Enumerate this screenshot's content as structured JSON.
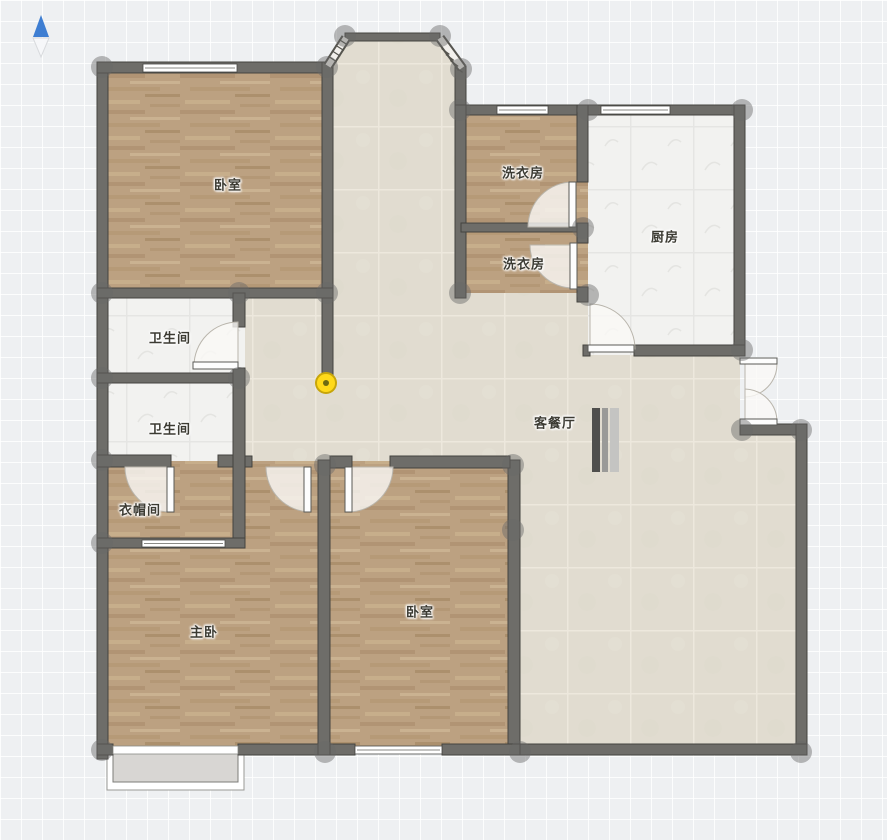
{
  "app": {
    "name": "floor-plan-editor-canvas"
  },
  "colors": {
    "canvas_bg": "#eef0f2",
    "grid_line": "#ffffff",
    "wall_fill": "#6e6d69",
    "wall_stroke": "#44433f",
    "wood_floor": "#bca181",
    "beige_tile": "#e1dcd0",
    "white_tile": "#f2f2f0",
    "handle": "rgba(105,105,105,0.45)",
    "door_leaf": "#fdfdfd",
    "door_swing_fill": "rgba(250,249,246,0.8)",
    "door_swing_stroke": "#b9b5ac",
    "window_fill": "#ffffff",
    "window_stroke": "#4a4a46",
    "selected_point": "#ffd91a",
    "compass_north": "#3e7ed2"
  },
  "compass": {
    "x": 41,
    "y": 15,
    "north_color": "#3e7ed2",
    "south_color": "#f6f7f9",
    "south_edge": "#d8dadd"
  },
  "marker": {
    "x": 326,
    "y": 383,
    "r": 10,
    "fill": "#ffd91a",
    "ring": "#c7a50a",
    "dot": "#6e6a12"
  },
  "rooms": [
    {
      "id": "bedroom-top",
      "label": "卧室",
      "x": 228,
      "y": 184
    },
    {
      "id": "laundry-upper",
      "label": "洗衣房",
      "x": 523,
      "y": 172
    },
    {
      "id": "laundry-lower",
      "label": "洗衣房",
      "x": 524,
      "y": 263
    },
    {
      "id": "kitchen",
      "label": "厨房",
      "x": 665,
      "y": 236
    },
    {
      "id": "bath-upper",
      "label": "卫生间",
      "x": 170,
      "y": 337
    },
    {
      "id": "bath-lower",
      "label": "卫生间",
      "x": 170,
      "y": 428
    },
    {
      "id": "living-dining",
      "label": "客餐厅",
      "x": 555,
      "y": 422
    },
    {
      "id": "cloakroom",
      "label": "衣帽间",
      "x": 140,
      "y": 509
    },
    {
      "id": "master-bedroom",
      "label": "主卧",
      "x": 204,
      "y": 631
    },
    {
      "id": "bedroom-bottom",
      "label": "卧室",
      "x": 420,
      "y": 611
    }
  ],
  "plan": {
    "beige_polys": [
      "345,36 440,36 464,66 464,110 327,110 327,62",
      "327,62 461,62 461,298 327,298",
      "240,293 588,293 588,350 740,350 740,430 801,430 801,748 514,748 514,464 240,464"
    ],
    "white_rects": [
      [
        588,
        110,
        152,
        245
      ],
      [
        103,
        293,
        142,
        85
      ],
      [
        103,
        378,
        142,
        83
      ]
    ],
    "wood_rects": [
      [
        103,
        67,
        224,
        226
      ],
      [
        461,
        110,
        127,
        118
      ],
      [
        461,
        228,
        127,
        65
      ],
      [
        103,
        461,
        224,
        292
      ],
      [
        326,
        461,
        188,
        292
      ]
    ],
    "walls": [
      [
        97,
        62,
        11,
        697
      ],
      [
        97,
        62,
        236,
        11
      ],
      [
        322,
        62,
        11,
        321
      ],
      [
        97,
        288,
        236,
        10
      ],
      [
        345,
        33,
        95,
        8
      ],
      [
        455,
        66,
        11,
        49
      ],
      [
        455,
        105,
        290,
        10
      ],
      [
        455,
        105,
        11,
        193
      ],
      [
        461,
        223,
        121,
        9
      ],
      [
        577,
        105,
        11,
        77
      ],
      [
        577,
        223,
        11,
        20
      ],
      [
        577,
        287,
        11,
        15
      ],
      [
        734,
        105,
        11,
        250
      ],
      [
        583,
        345,
        7,
        11
      ],
      [
        634,
        345,
        111,
        11
      ],
      [
        740,
        424,
        67,
        11
      ],
      [
        796,
        424,
        11,
        331
      ],
      [
        510,
        744,
        297,
        11
      ],
      [
        508,
        460,
        12,
        295
      ],
      [
        97,
        744,
        16,
        11
      ],
      [
        238,
        744,
        117,
        11
      ],
      [
        442,
        744,
        78,
        11
      ],
      [
        97,
        455,
        74,
        12
      ],
      [
        218,
        455,
        27,
        12
      ],
      [
        240,
        456,
        12,
        11
      ],
      [
        318,
        460,
        12,
        295
      ],
      [
        330,
        456,
        22,
        12
      ],
      [
        390,
        456,
        120,
        12
      ],
      [
        97,
        373,
        148,
        10
      ],
      [
        233,
        293,
        12,
        34
      ],
      [
        233,
        368,
        12,
        177
      ],
      [
        97,
        538,
        148,
        10
      ]
    ],
    "windows": [
      [
        143,
        64,
        94,
        8
      ],
      [
        497,
        106,
        51,
        8
      ],
      [
        601,
        106,
        69,
        8
      ],
      [
        142,
        540,
        83,
        7
      ],
      [
        355,
        746,
        87,
        8
      ]
    ],
    "bay": {
      "bands": [
        [
          328,
          66,
          346,
          38
        ],
        [
          440,
          38,
          462,
          68
        ]
      ],
      "ticks": [
        [
          328.3,
          56.3,
          336.7,
          61.7
        ],
        [
          331.9,
          50.7,
          340.3,
          56.1
        ],
        [
          335.5,
          45.1,
          343.9,
          50.5
        ],
        [
          339.1,
          39.5,
          347.5,
          44.9
        ],
        [
          441.5,
          48.5,
          449.4,
          54.4
        ],
        [
          445.9,
          54.5,
          453.8,
          60.4
        ],
        [
          450.3,
          60.5,
          458.2,
          66.4
        ],
        [
          454.7,
          66.5,
          462.6,
          72.4
        ]
      ]
    },
    "door_leaves": [
      [
        569,
        182,
        7,
        45
      ],
      [
        570,
        243,
        7,
        46
      ],
      [
        588,
        345,
        46,
        7
      ],
      [
        193,
        362,
        45,
        7
      ],
      [
        167,
        467,
        7,
        45
      ],
      [
        304,
        467,
        7,
        45
      ],
      [
        345,
        467,
        7,
        45
      ],
      [
        740,
        358,
        37,
        6
      ],
      [
        740,
        419,
        37,
        6
      ]
    ],
    "door_swings": [
      "M573,227 L573,182 A45,45 0 0 0 528,227 Z",
      "M573,245 L573,288 A43,43 0 0 1 530,245 Z",
      "M590,349 L635,349 A45,45 0 0 0 590,304 Z",
      "M238,366 L194,366 A44,44 0 0 1 238,322 Z",
      "M170,467 L170,512 A45,45 0 0 1 125,467 Z",
      "M311,467 L311,512 A45,45 0 0 1 266,467 Z",
      "M348,467 L348,512 A45,45 0 0 0 393,467 Z",
      "M745,364 L777,364 A33,33 0 0 1 745,397 Z",
      "M745,422 L777,422 A33,33 0 0 0 745,389 Z"
    ],
    "handles": [
      [
        102,
        67
      ],
      [
        327,
        67
      ],
      [
        345,
        36
      ],
      [
        440,
        36
      ],
      [
        461,
        69
      ],
      [
        102,
        293
      ],
      [
        239,
        293
      ],
      [
        327,
        293
      ],
      [
        460,
        110
      ],
      [
        588,
        110
      ],
      [
        742,
        110
      ],
      [
        583,
        228
      ],
      [
        460,
        293
      ],
      [
        588,
        295
      ],
      [
        742,
        350
      ],
      [
        742,
        430
      ],
      [
        801,
        430
      ],
      [
        102,
        378
      ],
      [
        239,
        378
      ],
      [
        102,
        460
      ],
      [
        325,
        465
      ],
      [
        513,
        465
      ],
      [
        102,
        543
      ],
      [
        513,
        530
      ],
      [
        102,
        750
      ],
      [
        325,
        752
      ],
      [
        520,
        752
      ],
      [
        801,
        752
      ]
    ],
    "radiator": [
      [
        592,
        408,
        8,
        64,
        "#4f4f4d"
      ],
      [
        602,
        408,
        6,
        64,
        "#9a9a98"
      ],
      [
        610,
        408,
        9,
        64,
        "#c4c4c2"
      ]
    ],
    "balcony": {
      "outer": [
        107,
        753,
        137,
        37
      ],
      "slab": [
        113,
        753,
        125,
        29
      ],
      "sill": [
        113,
        746,
        125,
        8
      ]
    }
  }
}
